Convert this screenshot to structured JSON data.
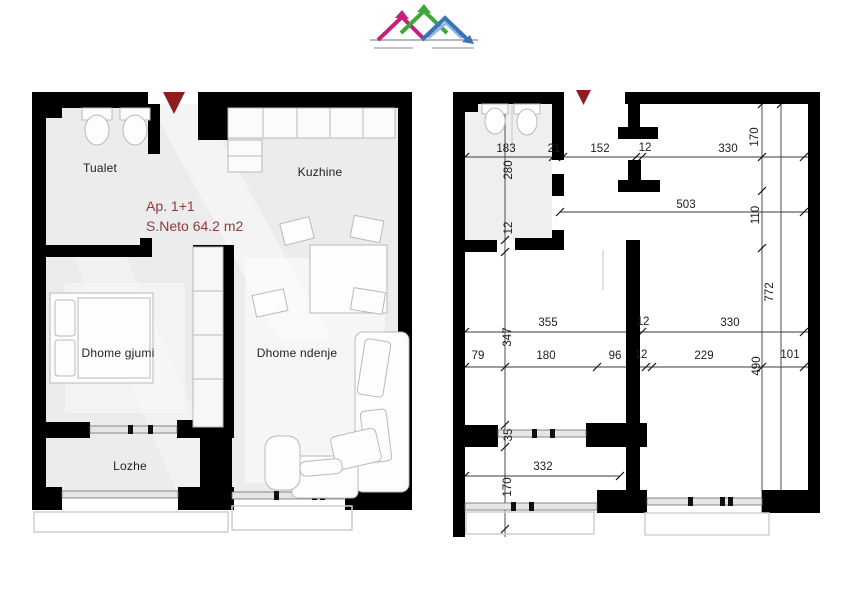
{
  "logo": {
    "name": "roofline-logo",
    "colors": {
      "pink": "#c32179",
      "green": "#3fa63a",
      "blue": "#3c72b8",
      "light_blue": "#8fb9e0",
      "gray": "#b9b9b9"
    }
  },
  "left_plan": {
    "apartment_label": "Ap. 1+1",
    "area_label": "S.Neto 64.2 m2",
    "accent_color": "#8e3b3b",
    "entrance_marker_color": "#8f1d1d",
    "wall_color": "#000000",
    "rooms": [
      {
        "id": "tualet",
        "label": "Tualet"
      },
      {
        "id": "kuzhine",
        "label": "Kuzhine"
      },
      {
        "id": "dhome-gjumi",
        "label": "Dhome gjumi"
      },
      {
        "id": "dhome-ndenje",
        "label": "Dhome ndenje"
      },
      {
        "id": "lozhe",
        "label": "Lozhe"
      }
    ]
  },
  "right_plan": {
    "dimensions_horizontal": [
      {
        "v": "183",
        "x": 58,
        "y": 61
      },
      {
        "v": "21",
        "x": 106,
        "y": 61
      },
      {
        "v": "152",
        "x": 152,
        "y": 61
      },
      {
        "v": "12",
        "x": 197,
        "y": 60
      },
      {
        "v": "330",
        "x": 280,
        "y": 61
      },
      {
        "v": "503",
        "x": 238,
        "y": 117
      },
      {
        "v": "355",
        "x": 100,
        "y": 235
      },
      {
        "v": "12",
        "x": 195,
        "y": 234
      },
      {
        "v": "330",
        "x": 282,
        "y": 235
      },
      {
        "v": "79",
        "x": 30,
        "y": 268
      },
      {
        "v": "180",
        "x": 98,
        "y": 268
      },
      {
        "v": "96",
        "x": 167,
        "y": 268
      },
      {
        "v": "12",
        "x": 193,
        "y": 267
      },
      {
        "v": "229",
        "x": 256,
        "y": 268
      },
      {
        "v": "101",
        "x": 342,
        "y": 267
      },
      {
        "v": "332",
        "x": 95,
        "y": 379
      }
    ],
    "dimensions_vertical": [
      {
        "v": "280",
        "x": 61,
        "y": 82
      },
      {
        "v": "12",
        "x": 61,
        "y": 140
      },
      {
        "v": "347",
        "x": 60,
        "y": 249
      },
      {
        "v": "35",
        "x": 61,
        "y": 347
      },
      {
        "v": "170",
        "x": 60,
        "y": 399
      },
      {
        "v": "170",
        "x": 307,
        "y": 49
      },
      {
        "v": "110",
        "x": 308,
        "y": 127
      },
      {
        "v": "772",
        "x": 322,
        "y": 204
      },
      {
        "v": "490",
        "x": 309,
        "y": 278
      }
    ]
  }
}
